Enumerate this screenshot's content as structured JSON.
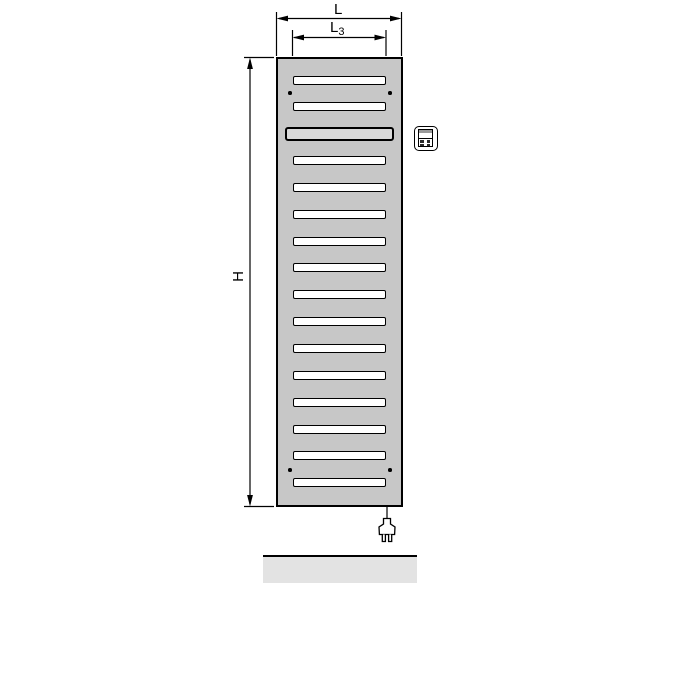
{
  "dimension_labels": {
    "overall_width": "L",
    "slot_width_base": "L",
    "slot_width_sub": "3",
    "height": "H"
  },
  "radiator": {
    "panel_fill": "#c7c7c7",
    "slot_fill": "#ffffff",
    "framed_slot_fill": "#d9d9d9",
    "outline_color": "#000000",
    "slots": [
      "plain",
      "plain",
      "framed",
      "plain",
      "plain",
      "plain",
      "plain",
      "plain",
      "plain",
      "plain",
      "plain",
      "plain",
      "plain",
      "plain",
      "plain",
      "plain"
    ],
    "screw_hole_positions": [
      "top-left",
      "top-right",
      "bottom-left",
      "bottom-right"
    ]
  },
  "accessories": {
    "control_unit_icon": "thermostat-control-icon",
    "power_plug_icon": "power-plug-icon",
    "floor_fill": "#e3e3e3"
  }
}
